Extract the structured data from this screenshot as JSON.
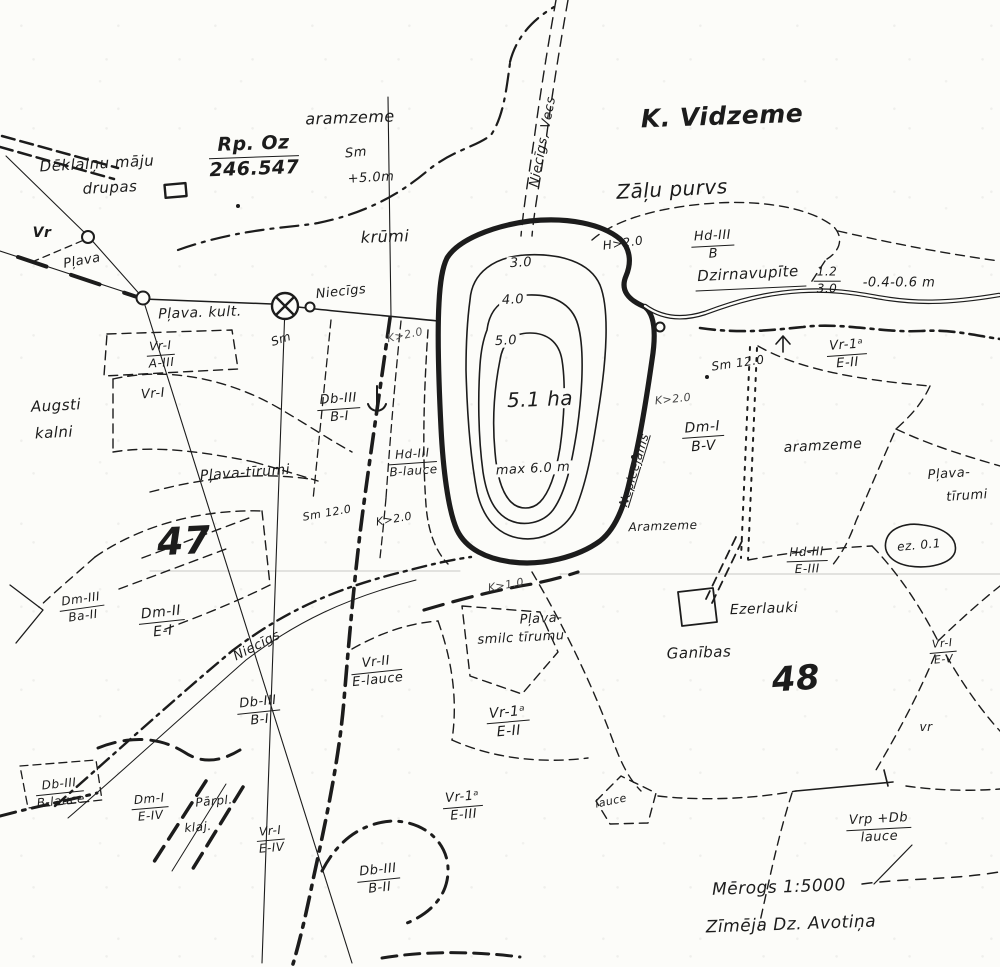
{
  "map": {
    "type": "scanned hand-drawn land survey map",
    "ink_color": "#1c1c1c",
    "paper_color": "#fcfcf9",
    "lake_area_label": "5.1 ha",
    "lake_max_depth": "max 6.0 m",
    "scale_note": "Mērogs 1:5000",
    "credit": "Zīmēja Dz. Avotiņa"
  },
  "labels": [
    {
      "name": "label-deklaini-maju",
      "text": "Dēklaiņu māju",
      "x": 97,
      "y": 164,
      "rot": -3,
      "fs": 15,
      "fw": 500
    },
    {
      "name": "label-drupas",
      "text": "drupas",
      "x": 110,
      "y": 188,
      "rot": -3,
      "fs": 15,
      "fw": 500
    },
    {
      "name": "label-aramzeme-north",
      "text": "aramzeme",
      "x": 350,
      "y": 118,
      "rot": -2,
      "fs": 16
    },
    {
      "name": "label-sm-north",
      "text": "Sm",
      "x": 356,
      "y": 153,
      "rot": -5,
      "fs": 13
    },
    {
      "name": "label-plus-5m",
      "text": "+5.0m",
      "x": 371,
      "y": 178,
      "rot": -3,
      "fs": 13
    },
    {
      "name": "label-k-vidzeme",
      "text": "K. Vidzeme",
      "x": 722,
      "y": 116,
      "rot": -2,
      "fs": 25,
      "fw": 600
    },
    {
      "name": "label-niecigs-vecs",
      "text": "Niecīgs, Vecs",
      "x": 543,
      "y": 142,
      "rot": -79,
      "fs": 13
    },
    {
      "name": "label-zalu-purvs",
      "text": "Zāļu purvs",
      "x": 672,
      "y": 189,
      "rot": -3,
      "fs": 20,
      "fw": 500
    },
    {
      "name": "label-h20-purvs",
      "text": "H>2.0",
      "x": 623,
      "y": 243,
      "rot": -8,
      "fs": 12
    },
    {
      "name": "label-dzirnavupite",
      "text": "Dzirnavupīte",
      "x": 748,
      "y": 274,
      "rot": -3,
      "fs": 15,
      "fw": 500
    },
    {
      "name": "label-depth-note",
      "text": "-0.4-0.6 m",
      "x": 899,
      "y": 283,
      "rot": 0,
      "fs": 13,
      "fw": 500
    },
    {
      "name": "label-vr-point",
      "text": "Vr",
      "x": 42,
      "y": 233,
      "rot": 0,
      "fs": 14,
      "fw": 600
    },
    {
      "name": "label-plava-nw",
      "text": "Pļava",
      "x": 82,
      "y": 261,
      "rot": -10,
      "fs": 13
    },
    {
      "name": "label-plava-kult",
      "text": "Pļava. kult.",
      "x": 200,
      "y": 313,
      "rot": -2,
      "fs": 14,
      "fw": 500
    },
    {
      "name": "label-sm-mill",
      "text": "Sm",
      "x": 281,
      "y": 339,
      "rot": -18,
      "fs": 12
    },
    {
      "name": "label-niecigs-west",
      "text": "Niecīgs",
      "x": 341,
      "y": 292,
      "rot": -6,
      "fs": 13
    },
    {
      "name": "label-krumi",
      "text": "krūmi",
      "x": 385,
      "y": 237,
      "rot": -2,
      "fs": 16
    },
    {
      "name": "label-k20-faint",
      "text": "K>2.0",
      "x": 405,
      "y": 335,
      "rot": -12,
      "fs": 11,
      "color": "#555555"
    },
    {
      "name": "label-contour-3",
      "text": "3.0",
      "x": 521,
      "y": 263,
      "rot": -3,
      "fs": 13,
      "fw": 500,
      "bg": true
    },
    {
      "name": "label-contour-4",
      "text": "4.0",
      "x": 513,
      "y": 300,
      "rot": -3,
      "fs": 13,
      "fw": 500,
      "bg": true
    },
    {
      "name": "label-contour-5",
      "text": "5.0",
      "x": 506,
      "y": 341,
      "rot": -3,
      "fs": 13,
      "fw": 500,
      "bg": true
    },
    {
      "name": "label-lake-area",
      "text": "5.1 ha",
      "x": 540,
      "y": 399,
      "rot": -2,
      "fs": 20,
      "fw": 500,
      "bg": true
    },
    {
      "name": "label-max-depth",
      "text": "max 6.0 m",
      "x": 533,
      "y": 469,
      "rot": -3,
      "fs": 13,
      "fw": 500,
      "bg": true
    },
    {
      "name": "label-nepieejams",
      "text": "Nepieejams",
      "x": 634,
      "y": 470,
      "rot": -73,
      "fs": 12,
      "ul": true
    },
    {
      "name": "label-k20-east",
      "text": "K>2.0",
      "x": 673,
      "y": 399,
      "rot": -6,
      "fs": 11,
      "color": "#444444"
    },
    {
      "name": "label-sm12-east",
      "text": "Sm 12.0",
      "x": 738,
      "y": 363,
      "rot": -8,
      "fs": 12
    },
    {
      "name": "label-aramzeme-east",
      "text": "aramzeme",
      "x": 823,
      "y": 446,
      "rot": -3,
      "fs": 14
    },
    {
      "name": "label-plava-se-1",
      "text": "Pļava-",
      "x": 949,
      "y": 474,
      "rot": -4,
      "fs": 13
    },
    {
      "name": "label-plava-se-2",
      "text": "tīrumi",
      "x": 967,
      "y": 496,
      "rot": -4,
      "fs": 13
    },
    {
      "name": "label-aramzeme-south",
      "text": "Aramzeme",
      "x": 663,
      "y": 526,
      "rot": -2,
      "fs": 12
    },
    {
      "name": "label-ez-01",
      "text": "ez. 0.1",
      "x": 919,
      "y": 545,
      "rot": -5,
      "fs": 12
    },
    {
      "name": "label-k10",
      "text": "K>1.0",
      "x": 506,
      "y": 585,
      "rot": -10,
      "fs": 11,
      "color": "#444444"
    },
    {
      "name": "label-plava-smilc-1",
      "text": "Pļava-",
      "x": 541,
      "y": 619,
      "rot": -3,
      "fs": 13
    },
    {
      "name": "label-plava-smilc-2",
      "text": "smilc tīrumu",
      "x": 521,
      "y": 638,
      "rot": -3,
      "fs": 13
    },
    {
      "name": "label-ezerlauki",
      "text": "Ezerlauki",
      "x": 764,
      "y": 609,
      "rot": -2,
      "fs": 14,
      "fw": 500
    },
    {
      "name": "label-ganibas",
      "text": "Ganības",
      "x": 699,
      "y": 653,
      "rot": -2,
      "fs": 15,
      "fw": 500
    },
    {
      "name": "label-parcel-48",
      "text": "48",
      "x": 796,
      "y": 679,
      "rot": -4,
      "fs": 34,
      "fw": 700
    },
    {
      "name": "label-parcel-47",
      "text": "47",
      "x": 184,
      "y": 541,
      "rot": -3,
      "fs": 38,
      "fw": 700
    },
    {
      "name": "label-augsti",
      "text": "Augsti",
      "x": 56,
      "y": 406,
      "rot": -3,
      "fs": 15,
      "fw": 500
    },
    {
      "name": "label-kalni",
      "text": "kalni",
      "x": 54,
      "y": 433,
      "rot": -3,
      "fs": 15,
      "fw": 500
    },
    {
      "name": "label-vr1-left",
      "text": "Vr-I",
      "x": 153,
      "y": 394,
      "rot": -5,
      "fs": 13
    },
    {
      "name": "label-plava-tirumi-west",
      "text": "Pļava-tīrumi",
      "x": 245,
      "y": 473,
      "rot": -4,
      "fs": 14
    },
    {
      "name": "label-sm12-west",
      "text": "Sm 12.0",
      "x": 327,
      "y": 513,
      "rot": -10,
      "fs": 11
    },
    {
      "name": "label-k20-west",
      "text": "K>2.0",
      "x": 394,
      "y": 519,
      "rot": -10,
      "fs": 11
    },
    {
      "name": "label-niecigs-south",
      "text": "Niecīgs",
      "x": 257,
      "y": 646,
      "rot": -27,
      "fs": 13
    },
    {
      "name": "label-parpl",
      "text": "Pārpl.",
      "x": 214,
      "y": 801,
      "rot": -5,
      "fs": 12
    },
    {
      "name": "label-klaj",
      "text": "klaj.",
      "x": 198,
      "y": 827,
      "rot": -5,
      "fs": 12
    },
    {
      "name": "label-lauce-south",
      "text": "lauce",
      "x": 611,
      "y": 801,
      "rot": -12,
      "fs": 11
    },
    {
      "name": "label-vr-se",
      "text": "vr",
      "x": 926,
      "y": 727,
      "rot": 0,
      "fs": 12
    },
    {
      "name": "label-scale",
      "text": "Mērogs 1:5000",
      "x": 779,
      "y": 888,
      "rot": -2,
      "fs": 17,
      "fw": 500
    },
    {
      "name": "label-credit",
      "text": "Zīmēja Dz. Avotiņa",
      "x": 791,
      "y": 925,
      "rot": -2,
      "fs": 17,
      "fw": 500
    }
  ],
  "fractions": [
    {
      "name": "fraction-rp-oz",
      "top": "Rp. Oz",
      "bottom": "246.547",
      "x": 254,
      "y": 157,
      "rot": -2,
      "fs": 19,
      "fw": 600
    },
    {
      "name": "fraction-hd3-b",
      "top": "Hd-III",
      "bottom": "B",
      "x": 713,
      "y": 246,
      "rot": -3,
      "fs": 13
    },
    {
      "name": "fraction-flow",
      "top": "1.2",
      "bottom": "3.0",
      "x": 827,
      "y": 281,
      "rot": 0,
      "fs": 12
    },
    {
      "name": "fraction-vr1-a3",
      "top": "Vr-I",
      "bottom": "A-III",
      "x": 161,
      "y": 355,
      "rot": -4,
      "fs": 12
    },
    {
      "name": "fraction-db3-b1-north",
      "top": "Db-III",
      "bottom": "B-I",
      "x": 339,
      "y": 409,
      "rot": -4,
      "fs": 13
    },
    {
      "name": "fraction-hd3-blauce",
      "top": "Hd-III",
      "bottom": "B-lauce",
      "x": 413,
      "y": 463,
      "rot": -4,
      "fs": 12
    },
    {
      "name": "fraction-dm1-bv",
      "top": "Dm-I",
      "bottom": "B-V",
      "x": 703,
      "y": 437,
      "rot": -4,
      "fs": 14
    },
    {
      "name": "fraction-vr1a-e2-ne",
      "top": "Vr-1ᵃ",
      "bottom": "E-II",
      "x": 847,
      "y": 355,
      "rot": -4,
      "fs": 13
    },
    {
      "name": "fraction-hd3-e3",
      "top": "Hd-III",
      "bottom": "E-III",
      "x": 807,
      "y": 561,
      "rot": -2,
      "fs": 12
    },
    {
      "name": "fraction-dm3-ba2",
      "top": "Dm-III",
      "bottom": "Ba-II",
      "x": 82,
      "y": 608,
      "rot": -8,
      "fs": 12
    },
    {
      "name": "fraction-dm2-e1",
      "top": "Dm-II",
      "bottom": "E-I",
      "x": 162,
      "y": 622,
      "rot": -6,
      "fs": 14
    },
    {
      "name": "fraction-db3-b1-south",
      "top": "Db-III",
      "bottom": "B-I",
      "x": 259,
      "y": 712,
      "rot": -6,
      "fs": 13
    },
    {
      "name": "fraction-vr2-elauce",
      "top": "Vr-II",
      "bottom": "E-lauce",
      "x": 377,
      "y": 672,
      "rot": -6,
      "fs": 13
    },
    {
      "name": "fraction-vr1a-e2-center",
      "top": "Vr-1ᵃ",
      "bottom": "E-II",
      "x": 508,
      "y": 722,
      "rot": -5,
      "fs": 14
    },
    {
      "name": "fraction-db3-blauce",
      "top": "Db-III",
      "bottom": "B-lauce",
      "x": 60,
      "y": 793,
      "rot": -6,
      "fs": 12
    },
    {
      "name": "fraction-dm1-e4",
      "top": "Dm-I",
      "bottom": "E-IV",
      "x": 150,
      "y": 808,
      "rot": -5,
      "fs": 12
    },
    {
      "name": "fraction-vr1-e4",
      "top": "Vr-I",
      "bottom": "E-IV",
      "x": 271,
      "y": 840,
      "rot": -5,
      "fs": 12
    },
    {
      "name": "fraction-vr1a-e3",
      "top": "Vr-1ᵃ",
      "bottom": "E-III",
      "x": 463,
      "y": 807,
      "rot": -5,
      "fs": 13
    },
    {
      "name": "fraction-db3-b2",
      "top": "Db-III",
      "bottom": "B-II",
      "x": 379,
      "y": 880,
      "rot": -6,
      "fs": 13
    },
    {
      "name": "fraction-vrp-db",
      "top": "Vrp +Db",
      "bottom": "lauce",
      "x": 879,
      "y": 829,
      "rot": -3,
      "fs": 13
    },
    {
      "name": "fraction-vr1-e5",
      "top": "Vr-I",
      "bottom": "E-V",
      "x": 943,
      "y": 652,
      "rot": -5,
      "fs": 11
    }
  ]
}
